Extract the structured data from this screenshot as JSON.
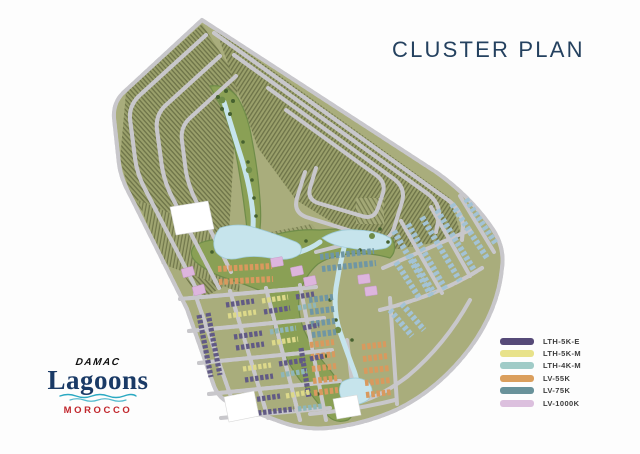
{
  "title": "CLUSTER PLAN",
  "logo": {
    "brand": "DAMAC",
    "name": "Lagoons",
    "region": "MOROCCO"
  },
  "legend": {
    "items": [
      {
        "label": "LTH-5K-E",
        "color": "#564a78"
      },
      {
        "label": "LTH-5K-M",
        "color": "#e8e28a"
      },
      {
        "label": "LTH-4K-M",
        "color": "#a0cbc7"
      },
      {
        "label": "LV-55K",
        "color": "#db9f5d"
      },
      {
        "label": "LV-75K",
        "color": "#69929a"
      },
      {
        "label": "LV-1000K",
        "color": "#dcc0de"
      }
    ]
  },
  "colors": {
    "land": "#a9ad7c",
    "land_edge": "#8f9465",
    "road": "#c8c7cb",
    "hatch_light": "#9aa06b",
    "hatch_dark": "#6d7348",
    "park": "#8aa055",
    "park_dark": "#6f8c49",
    "tree": "#46612f",
    "water": "#c6e4ec",
    "water_deep": "#9fcbd8",
    "house_purple": "#615a85",
    "house_yellow": "#ddd98a",
    "house_teal": "#8fb6b9",
    "house_blue": "#a3c3d6",
    "house_orange": "#d9995e",
    "house_slate": "#6f96a4",
    "house_pink": "#ddb5de",
    "title_text": "#24415f",
    "legend_text": "#3c3c3c",
    "morocco_red": "#c1272d",
    "lagoons_navy": "#1a3a66",
    "wave_teal": "#2aa9c2"
  }
}
